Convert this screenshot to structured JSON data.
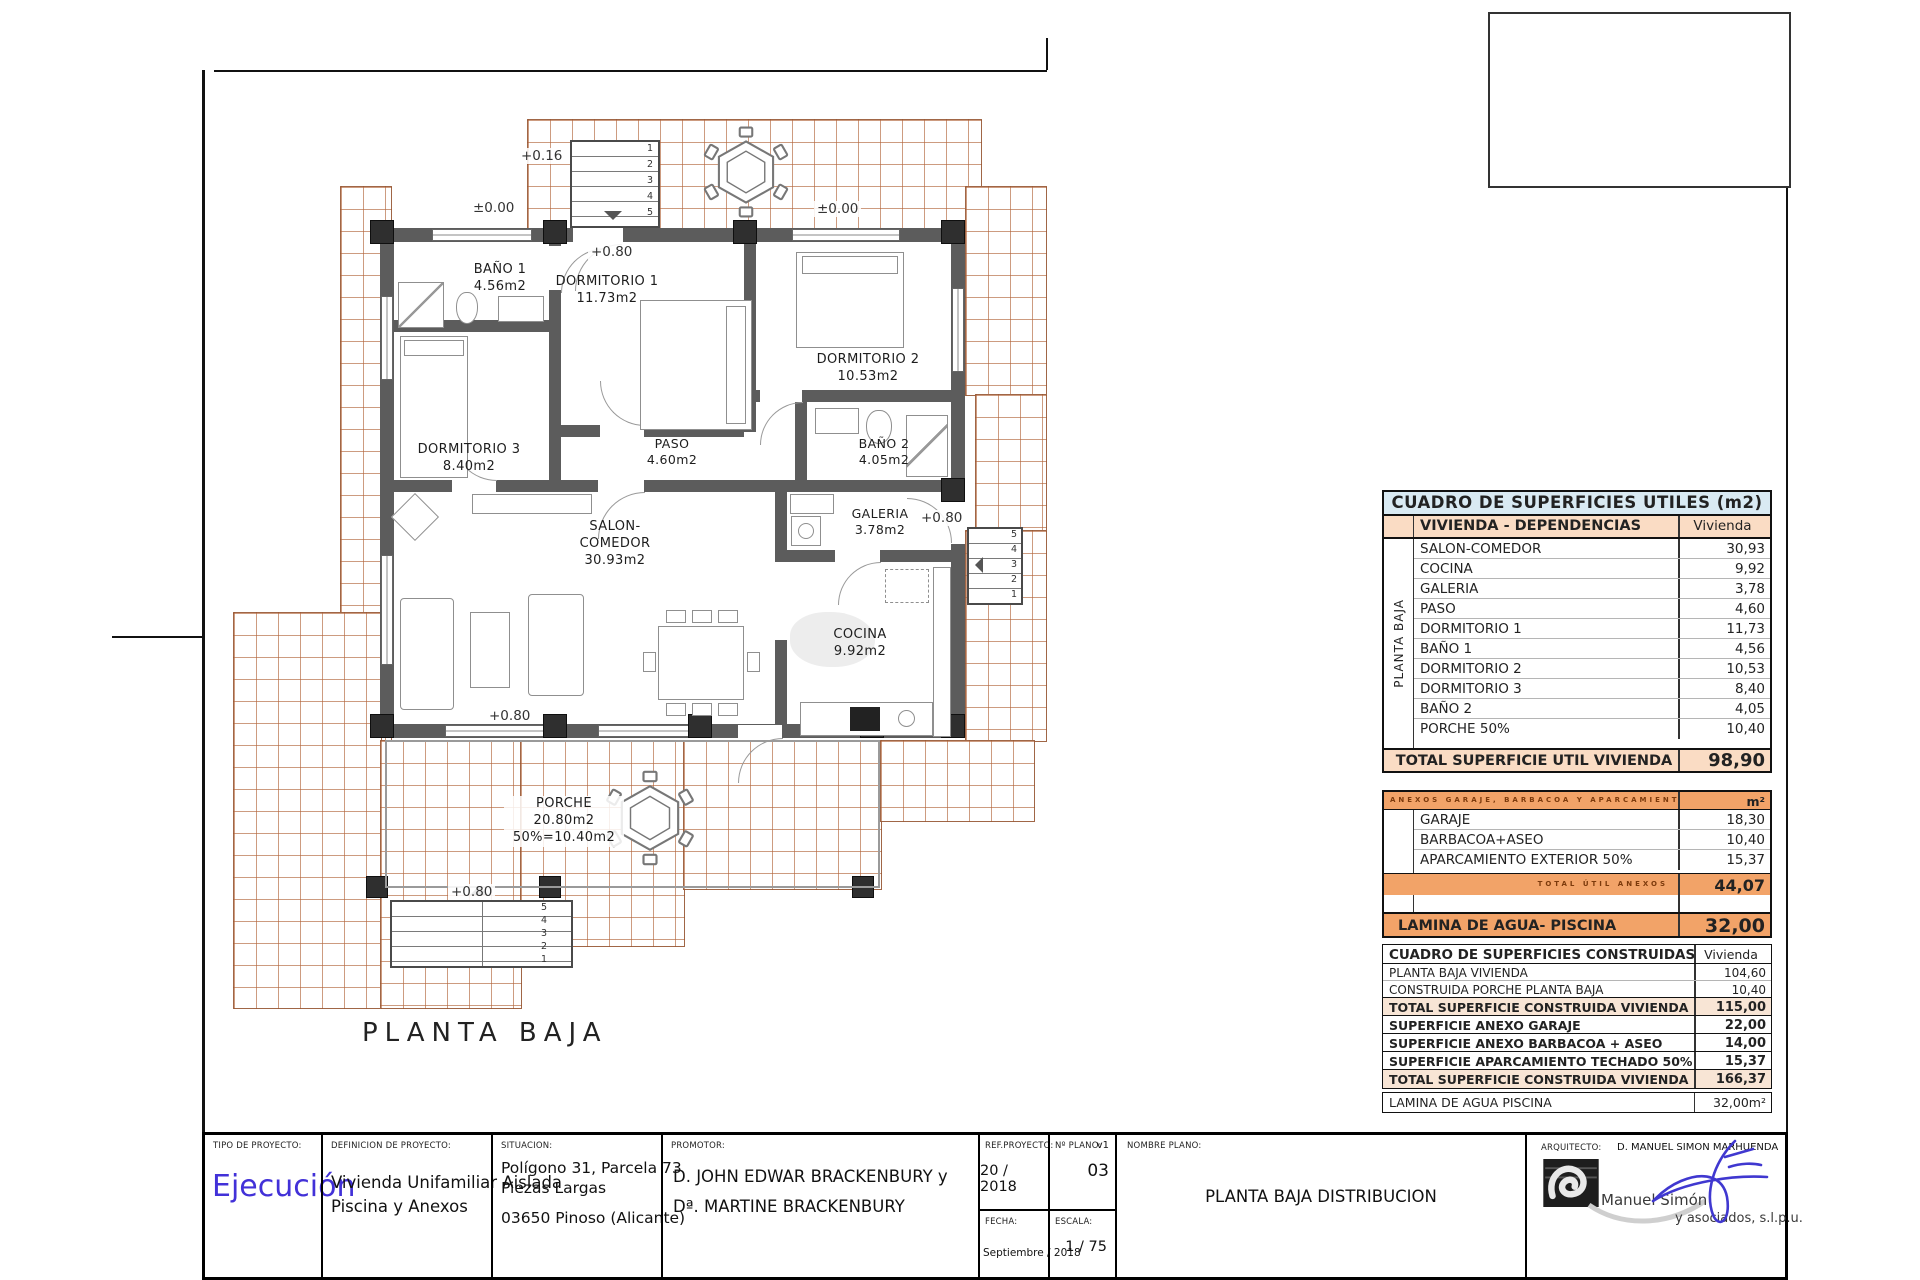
{
  "plan": {
    "title": "PLANTA BAJA",
    "rooms": [
      {
        "name": "BAÑO 1",
        "area": "4.56m2"
      },
      {
        "name": "DORMITORIO 1",
        "area": "11.73m2"
      },
      {
        "name": "DORMITORIO 2",
        "area": "10.53m2"
      },
      {
        "name": "DORMITORIO 3",
        "area": "8.40m2"
      },
      {
        "name": "PASO",
        "area": "4.60m2"
      },
      {
        "name": "BAÑO 2",
        "area": "4.05m2"
      },
      {
        "name": "SALON-COMEDOR",
        "area": "30.93m2"
      },
      {
        "name": "GALERIA",
        "area": "3.78m2"
      },
      {
        "name": "COCINA",
        "area": "9.92m2"
      },
      {
        "name": "PORCHE",
        "area": "20.80m2",
        "area2": "50%=10.40m2"
      }
    ],
    "levels": {
      "zero_left": "±0.00",
      "zero_right": "±0.00",
      "entry_top": "+0.16",
      "p080_entry": "+0.80",
      "p080_galeria": "+0.80",
      "p080_porch": "+0.80",
      "p080_stair": "+0.80"
    },
    "stair_numbers": [
      "1",
      "2",
      "3",
      "4",
      "5"
    ]
  },
  "tables": {
    "utiles": {
      "title": "CUADRO DE SUPERFICIES UTILES (m2)",
      "col_group": "VIVIENDA - DEPENDENCIAS",
      "col_value": "Vivienda",
      "side_label": "PLANTA BAJA",
      "rows": [
        {
          "name": "SALON-COMEDOR",
          "value": "30,93"
        },
        {
          "name": "COCINA",
          "value": "9,92"
        },
        {
          "name": "GALERIA",
          "value": "3,78"
        },
        {
          "name": "PASO",
          "value": "4,60"
        },
        {
          "name": "DORMITORIO 1",
          "value": "11,73"
        },
        {
          "name": "BAÑO 1",
          "value": "4,56"
        },
        {
          "name": "DORMITORIO 2",
          "value": "10,53"
        },
        {
          "name": "DORMITORIO 3",
          "value": "8,40"
        },
        {
          "name": "BAÑO 2",
          "value": "4,05"
        },
        {
          "name": "PORCHE 50%",
          "value": "10,40"
        }
      ],
      "total_label": "TOTAL SUPERFICIE UTIL VIVIENDA",
      "total_value": "98,90"
    },
    "anexos": {
      "title": "ANEXOS GARAJE, BARBACOA Y APARCAMIENTO",
      "unit": "m²",
      "rows": [
        {
          "name": "GARAJE",
          "value": "18,30"
        },
        {
          "name": "BARBACOA+ASEO",
          "value": "10,40"
        },
        {
          "name": "APARCAMIENTO EXTERIOR 50%",
          "value": "15,37"
        }
      ],
      "total_label": "TOTAL ÚTIL ANEXOS",
      "total_value": "44,07"
    },
    "lamina": {
      "label": "LAMINA DE AGUA- PISCINA",
      "value": "32,00"
    },
    "construidas": {
      "title": "CUADRO DE SUPERFICIES CONSTRUIDAS (m2)",
      "col_value": "Vivienda",
      "rows": [
        {
          "name": "PLANTA BAJA VIVIENDA",
          "value": "104,60"
        },
        {
          "name": "CONSTRUIDA PORCHE PLANTA BAJA",
          "value": "10,40"
        },
        {
          "name": "TOTAL SUPERFICIE CONSTRUIDA VIVIENDA",
          "value": "115,00"
        },
        {
          "name": "SUPERFICIE ANEXO GARAJE",
          "value": "22,00"
        },
        {
          "name": "SUPERFICIE ANEXO BARBACOA + ASEO",
          "value": "14,00"
        },
        {
          "name": "SUPERFICIE APARCAMIENTO TECHADO 50%",
          "value": "15,37"
        },
        {
          "name": "TOTAL SUPERFICIE CONSTRUIDA VIVIENDA + ANEXOS",
          "value": "166,37"
        }
      ]
    },
    "lamina2": {
      "label": "LAMINA DE AGUA PISCINA",
      "value": "32,00m²"
    }
  },
  "titleblock": {
    "tipo_label": "TIPO DE PROYECTO:",
    "tipo_value": "Ejecución",
    "def_label": "DEFINICION DE PROYECTO:",
    "def_line1": "Vivienda Unifamiliar Aislada",
    "def_line2": "Piscina y Anexos",
    "sit_label": "SITUACION:",
    "sit_line1": "Polígono 31, Parcela 73",
    "sit_line2": "Piezas Largas",
    "sit_line3": "03650 Pinoso (Alicante)",
    "prom_label": "PROMOTOR:",
    "prom_line1": "D. JOHN EDWAR BRACKENBURY y",
    "prom_line2": "Dª. MARTINE BRACKENBURY",
    "ref_label": "REF.PROYECTO:",
    "ref_value": "20 / 2018",
    "plano_label": "Nº PLANO:",
    "plano_v": "v1",
    "plano_value": "03",
    "fecha_label": "FECHA:",
    "fecha_value": "Septiembre / 2018",
    "escala_label": "ESCALA:",
    "escala_value": "1 / 75",
    "nombre_label": "NOMBRE PLANO:",
    "nombre_value": "PLANTA BAJA DISTRIBUCION",
    "arq_label": "ARQUITECTO:",
    "arq_value": "D. MANUEL SIMON MARHUENDA",
    "firm_name": "Manuel Simón",
    "firm_sub": "y asociados, s.l.p.u."
  }
}
